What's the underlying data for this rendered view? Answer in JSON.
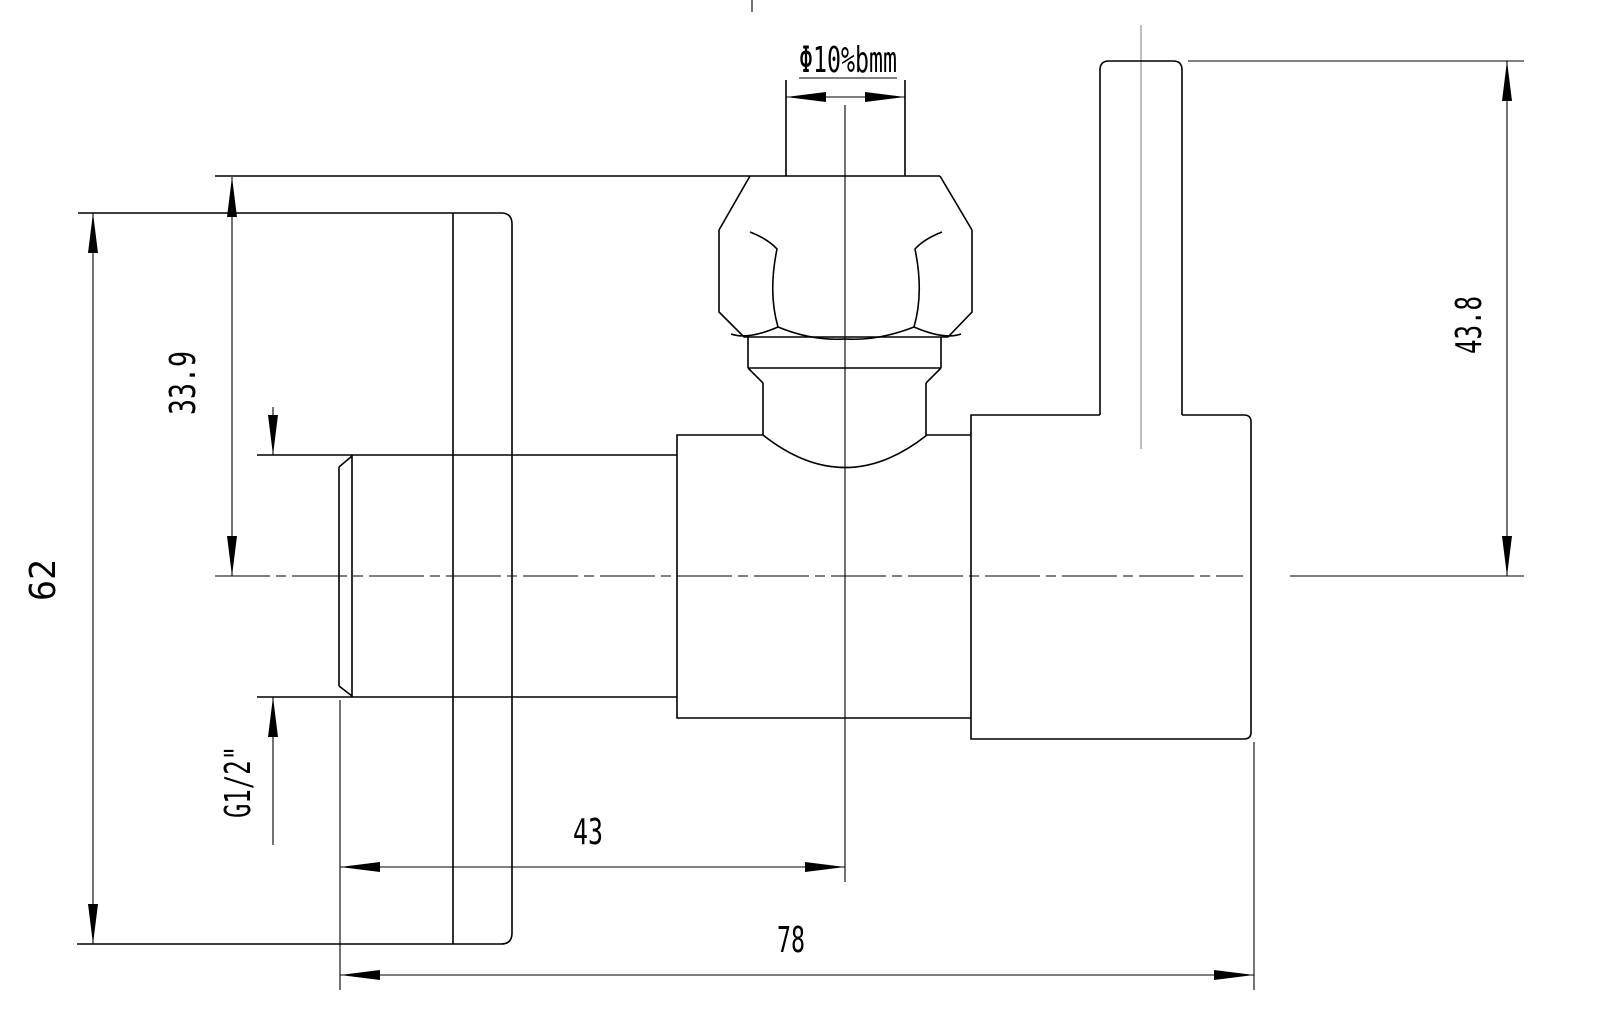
{
  "labels": {
    "tube_diameter": "Φ10%bmm",
    "nut_top_to_center": "33.9",
    "overall_height": "62",
    "inlet_thread": "G1/2\"",
    "center_to_inlet_end": "43",
    "overall_length": "78",
    "handle_top_to_center": "43.8"
  },
  "colors": {
    "line": "#000000",
    "background": "#ffffff",
    "centerline_gray": "#7d7d7d"
  }
}
